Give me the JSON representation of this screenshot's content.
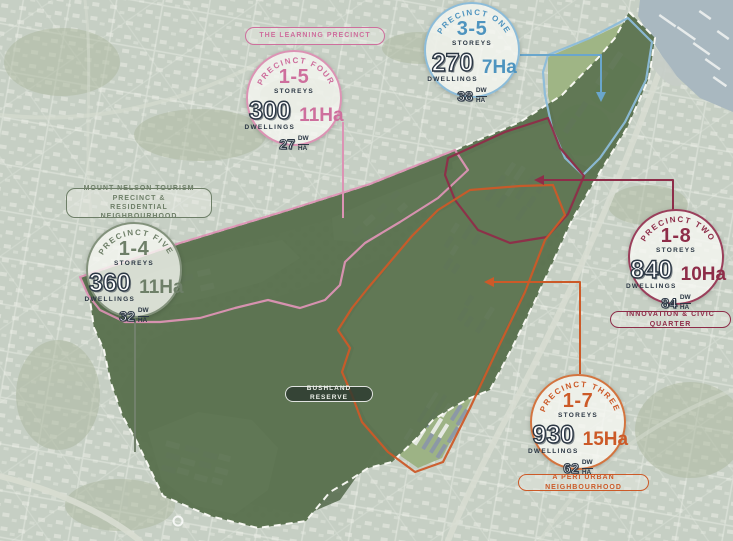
{
  "title": "Precinct masterplan aerial map",
  "labels": {
    "learning": "THE LEARNING PRECINCT",
    "mount_nelson_line1": "MOUNT NELSON TOURISM PRECINCT &",
    "mount_nelson_line2": "RESIDENTIAL NEIGHBOURHOOD",
    "innovation": "INNOVATION & CIVIC QUARTER",
    "peri_urban": "A PERI URBAN NEIGHBOURHOOD",
    "bushland": "BUSHLAND RESERVE"
  },
  "precincts": {
    "one": {
      "name": "PRECINCT ONE",
      "storeys": "3-5",
      "storeys_label": "STOREYS",
      "dwellings": "270",
      "dwellings_label": "DWELLINGS",
      "area": "7Ha",
      "density": "38",
      "density_top": "DW",
      "density_bottom": "HA",
      "color": "#4e94bf",
      "ring": "#8cbcd9"
    },
    "two": {
      "name": "PRECINCT TWO",
      "storeys": "1-8",
      "storeys_label": "STOREYS",
      "dwellings": "840",
      "dwellings_label": "DWELLINGS",
      "area": "10Ha",
      "density": "84",
      "density_top": "DW",
      "density_bottom": "HA",
      "color": "#8e2d49",
      "ring": "#9a3f5b"
    },
    "three": {
      "name": "PRECINCT THREE",
      "storeys": "1-7",
      "storeys_label": "STOREYS",
      "dwellings": "930",
      "dwellings_label": "DWELLINGS",
      "area": "15Ha",
      "density": "62",
      "density_top": "DW",
      "density_bottom": "HA",
      "color": "#cc5a28",
      "ring": "#d3743f"
    },
    "four": {
      "name": "PRECINCT FOUR",
      "storeys": "1-5",
      "storeys_label": "STOREYS",
      "dwellings": "300",
      "dwellings_label": "DWELLINGS",
      "area": "11Ha",
      "density": "27",
      "density_top": "DW",
      "density_bottom": "HA",
      "color": "#ce6f9d",
      "ring": "#dc93b4"
    },
    "five": {
      "name": "PRECINCT FIVE",
      "storeys": "1-4",
      "storeys_label": "STOREYS",
      "dwellings": "360",
      "dwellings_label": "DWELLINGS",
      "area": "11Ha",
      "density": "32",
      "density_top": "DW",
      "density_bottom": "HA",
      "color": "#6e7f68",
      "ring": "#83927c"
    }
  },
  "map_colors": {
    "background_land": "#c6cfc4",
    "water": "#a9b8c0",
    "site_green": "#5e7553",
    "bushland_dark": "#4b6142",
    "developed_pocket": "#9bb183",
    "sports_oval": "#76b757",
    "boundary_dashed": "#fdfdf8"
  }
}
